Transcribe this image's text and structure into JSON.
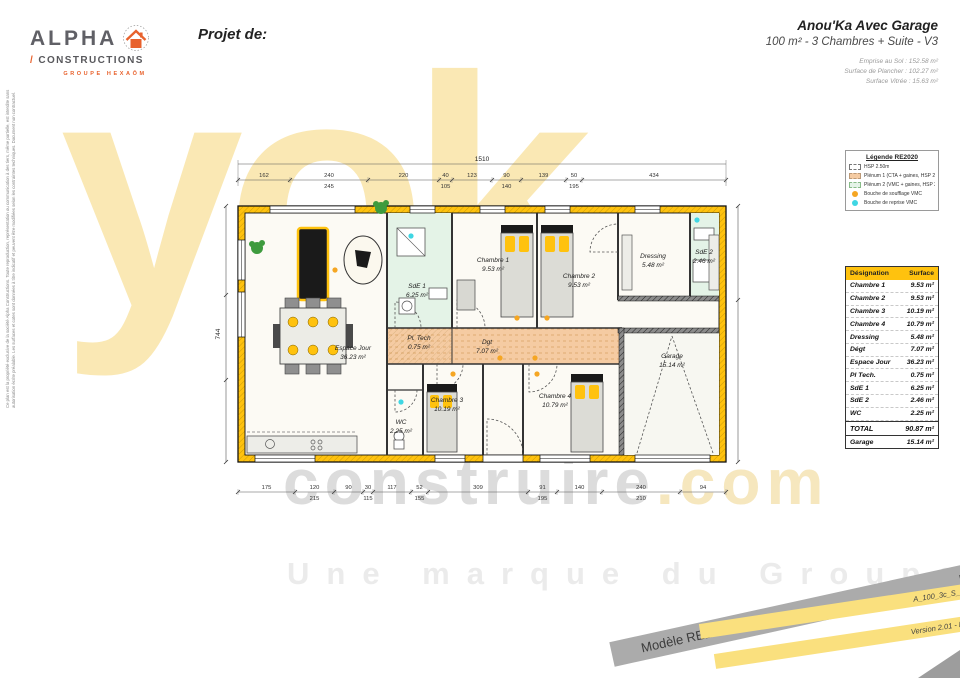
{
  "colors": {
    "wall": "#FFC20E",
    "corridor": "#F5CBA2",
    "wet": "#E4F3E7",
    "cream": "#FCFAF4",
    "dot_supply": "#F5A623",
    "dot_return": "#3FD6E3",
    "table_header": "#FFC20E",
    "band_gray": "#ABABAB",
    "band_yellow": "#FAE07E",
    "logo_orange": "#E8622D",
    "wm_yellow": "#FAE8B4",
    "wm_yellow2": "#F6E7BE",
    "wm_gray": "#DCDCDC"
  },
  "header": {
    "logo_line1": "ALPHA",
    "logo_line2": "CONSTRUCTIONS",
    "logo_tagline": "GROUPE HEXAÔM",
    "project_label": "Projet de:",
    "title": "Anou'Ka Avec Garage",
    "subtitle": "100 m² - 3 Chambres + Suite - V3",
    "metrics": [
      "Emprise au Sol : 152.58 m²",
      "Surface de Plancher : 102.27 m²",
      "Surface Vitrée : 15.63 m²"
    ]
  },
  "legal_note": "Ce plan est la propriété exclusive de la société Alpha Constructions. Toute reproduction, représentation ou communication à des tiers, même partielle, est interdite sans autorisation écrite préalable. Les surfaces et cotes sont données à titre indicatif et peuvent être modifiées selon les contraintes techniques. Document non contractuel.",
  "legend": {
    "title": "Légende RE2020",
    "items": [
      {
        "swatch": "dashed",
        "label": "HSP 2.50m"
      },
      {
        "swatch": "orange",
        "label": "Plénum 1 (CTA + gaines, HSP 2.04 m)"
      },
      {
        "swatch": "green",
        "label": "Plénum 2 (VMC + gaines, HSP 2.11 m)"
      },
      {
        "swatch": "dot-orange",
        "label": "Bouche de soufflage VMC"
      },
      {
        "swatch": "dot-cyan",
        "label": "Bouche de reprise VMC"
      }
    ]
  },
  "table": {
    "headers": [
      "Désignation",
      "Surface"
    ],
    "rows": [
      [
        "Chambre 1",
        "9.53 m²"
      ],
      [
        "Chambre 2",
        "9.53 m²"
      ],
      [
        "Chambre 3",
        "10.19 m²"
      ],
      [
        "Chambre 4",
        "10.79 m²"
      ],
      [
        "Dressing",
        "5.48 m²"
      ],
      [
        "Dégt",
        "7.07 m²"
      ],
      [
        "Espace Jour",
        "36.23 m²"
      ],
      [
        "Pl Tech.",
        "0.75 m²"
      ],
      [
        "SdE 1",
        "6.25 m²"
      ],
      [
        "SdE 2",
        "2.46 m²"
      ],
      [
        "WC",
        "2.25 m²"
      ]
    ],
    "total": [
      "TOTAL",
      "90.87 m²"
    ],
    "garage": [
      "Garage",
      "15.14 m²"
    ]
  },
  "plan": {
    "rooms": [
      {
        "name": "Chambre 1",
        "area": "9.53 m²"
      },
      {
        "name": "Chambre 2",
        "area": "9.53 m²"
      },
      {
        "name": "Chambre 3",
        "area": "10.19 m²"
      },
      {
        "name": "Chambre 4",
        "area": "10.79 m²"
      },
      {
        "name": "Dressing",
        "area": "5.48 m²"
      },
      {
        "name": "SdE 2",
        "area": "2.46 m²"
      },
      {
        "name": "SdE 1",
        "area": "6.25 m²"
      },
      {
        "name": "Espace Jour",
        "area": "36.23 m²"
      },
      {
        "name": "Pl. Tech",
        "area": "0.75 m²"
      },
      {
        "name": "Dgt",
        "area": "7.07 m²"
      },
      {
        "name": "WC",
        "area": "2.25 m²"
      },
      {
        "name": "Garage",
        "area": "15.14 m²"
      }
    ],
    "dims": {
      "total_top": "1510",
      "left_total": "744",
      "top": [
        "162",
        "240",
        "220",
        "40",
        "123",
        "90",
        "139",
        "50",
        "434"
      ],
      "top_sub": [
        "",
        "245",
        "",
        "105",
        "",
        "140",
        "",
        "195",
        ""
      ],
      "bottom": [
        "175",
        "120",
        "90",
        "30",
        "117",
        "52",
        "309",
        "91",
        "140",
        "240",
        "94"
      ],
      "bottom_sub": [
        "",
        "215",
        "",
        "115",
        "",
        "155",
        "",
        "195",
        "",
        "210",
        ""
      ]
    }
  },
  "watermark": {
    "big": "yok",
    "brand": "construire",
    "dotcom": ".com",
    "tagline": "Une marque du Groupe HDV"
  },
  "banners": {
    "gray_left": "Modèle RE2020",
    "gray_right": "Echelle : 1:75",
    "yellow1": "A_100_3c_S_G_V3",
    "yellow2": "Version 2.01 - Mars 2023"
  }
}
